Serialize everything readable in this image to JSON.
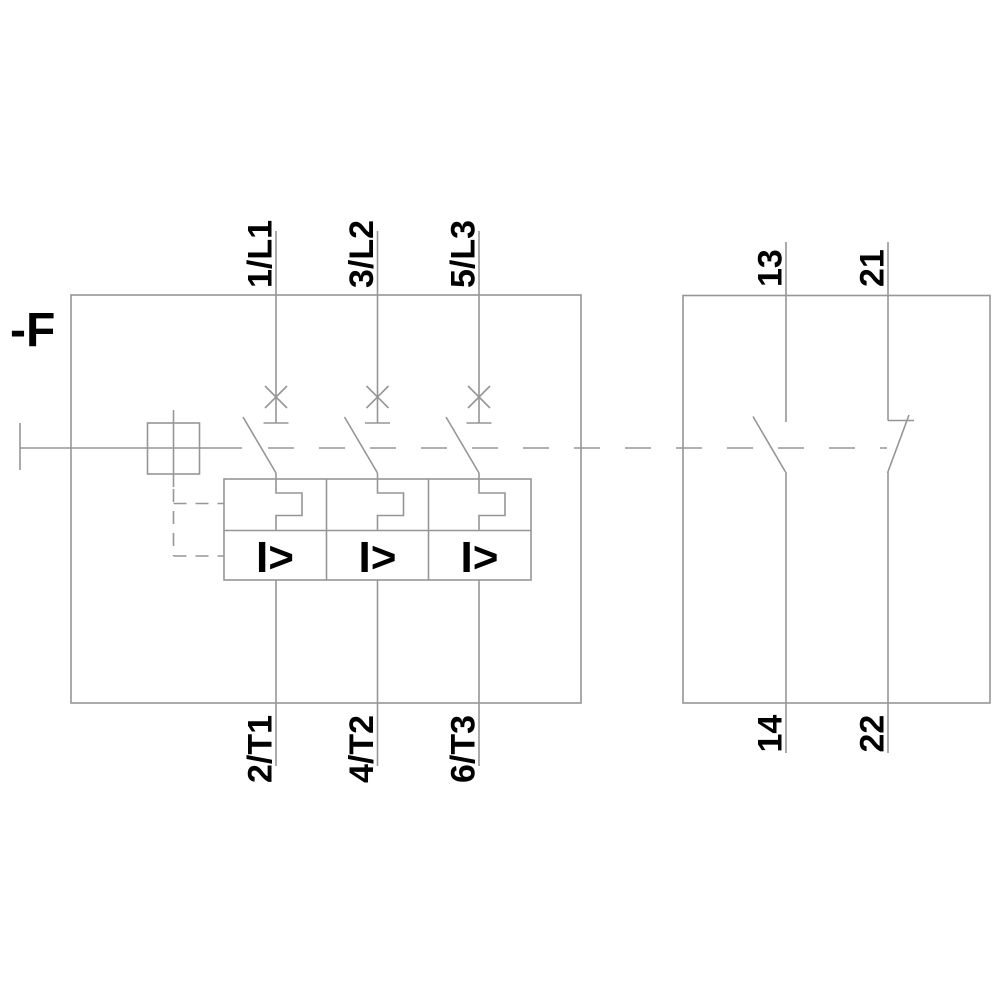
{
  "background_color": "#ffffff",
  "line_color": "#969696",
  "text_color": "#000000",
  "device": {
    "designation": "-F"
  },
  "main_breaker": {
    "poles": [
      {
        "top_terminal": "1/L1",
        "bottom_terminal": "2/T1",
        "magnetic_trip_symbol": "I>"
      },
      {
        "top_terminal": "3/L2",
        "bottom_terminal": "4/T2",
        "magnetic_trip_symbol": "I>"
      },
      {
        "top_terminal": "5/L3",
        "bottom_terminal": "6/T3",
        "magnetic_trip_symbol": "I>"
      }
    ]
  },
  "auxiliary_contacts": {
    "normally_open": {
      "top_terminal": "13",
      "bottom_terminal": "14"
    },
    "normally_closed": {
      "top_terminal": "21",
      "bottom_terminal": "22"
    }
  }
}
